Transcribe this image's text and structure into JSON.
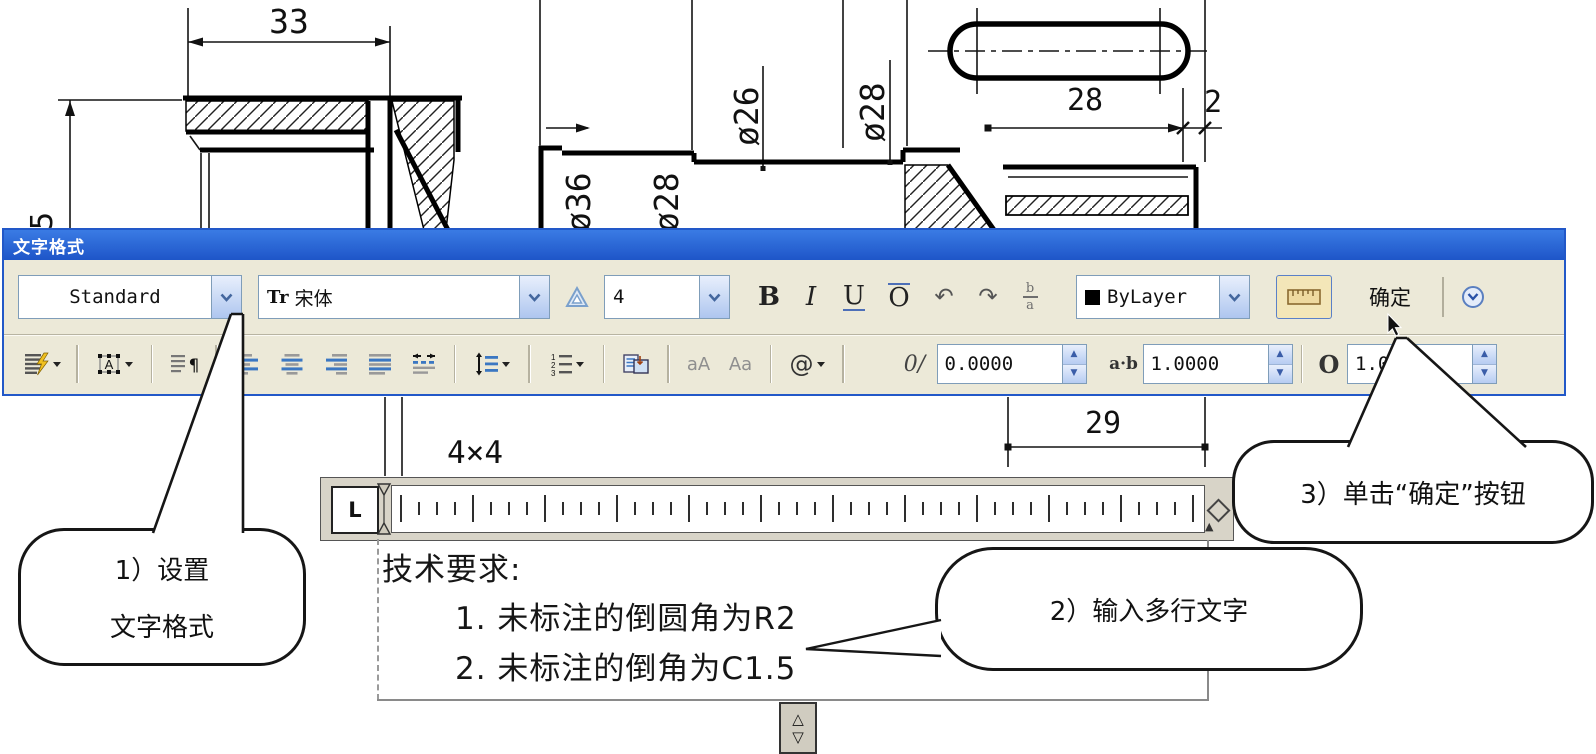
{
  "drawing": {
    "dim_33": "33",
    "dim_5": "5",
    "dim_phi36": "ø36",
    "dim_phi28_hub": "ø28",
    "dim_phi26": "ø26",
    "dim_phi28_shaft": "ø28",
    "dim_28": "28",
    "dim_2": "2",
    "dim_29": "29",
    "label_4x4": "4×4"
  },
  "dialog": {
    "title": "文字格式",
    "style_value": "Standard",
    "font_tt_icon": "Tr",
    "font_value": "宋体",
    "size_value": "4",
    "bold_label": "B",
    "italic_label": "I",
    "underline_label": "U",
    "overline_label": "O",
    "undo_icon": "↶",
    "redo_icon": "↷",
    "stack_top": "b",
    "stack_bottom": "a",
    "color_value": "ByLayer",
    "ok_label": "确定"
  },
  "format_row": {
    "lowercase_label": "aA",
    "uppercase_label": "Aa",
    "symbol_label": "@",
    "oblique_icon": "0/",
    "oblique_value": "0.0000",
    "tracking_icon": "a·b",
    "tracking_value": "1.0000",
    "width_icon": "O",
    "width_value": "1.0000"
  },
  "ruler": {
    "tab_label": "L"
  },
  "editor": {
    "line1": "技术要求:",
    "line2": "1. 未标注的倒圆角为R2",
    "line3": "2. 未标注的倒角为C1.5"
  },
  "callouts": {
    "step1_line1": "1）设置",
    "step1_line2": "文字格式",
    "step2": "2）输入多行文字",
    "step3": "3）单击“确定”按钮"
  },
  "colors": {
    "titlebar_blue": "#2563d4",
    "toolbar_bg": "#ece9d8",
    "accent_blue": "#3b77c2",
    "combo_border": "#7f9db9"
  }
}
